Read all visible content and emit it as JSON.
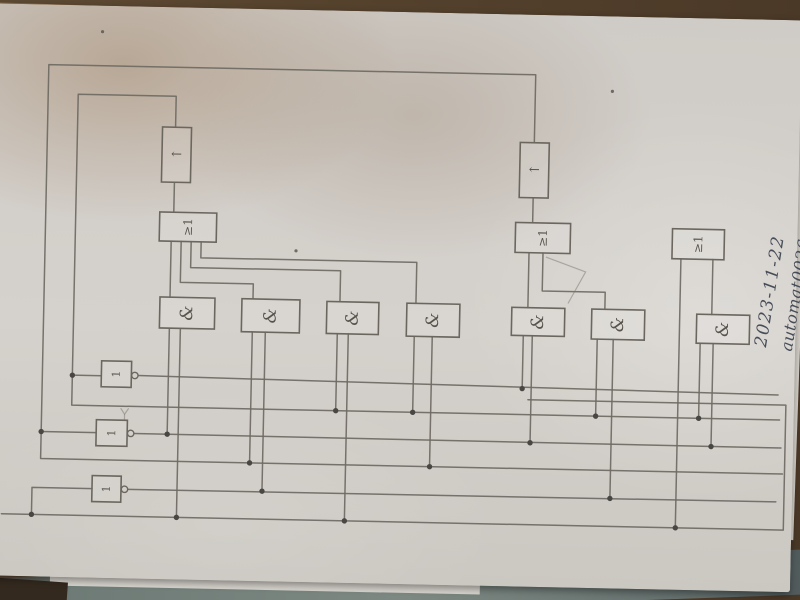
{
  "photo": {
    "handwriting": {
      "date": "2023-11-22",
      "filename": "automat0026.txt"
    }
  },
  "colors": {
    "pencil_line": "#6e6a63",
    "pencil_text": "#56534c",
    "ink_handwriting": "#474d58",
    "paper": "#d2cec9",
    "table_wood": "#55422d",
    "table_green": "#7d8882",
    "under_sheet_tan": "#c89f6c"
  },
  "schematic": {
    "boxes": [
      {
        "id": "ff1",
        "type": "flipflop-box",
        "label": "←",
        "x": 159,
        "y": 132,
        "w": 29,
        "h": 55,
        "rot": false,
        "fs": 13
      },
      {
        "id": "ff2",
        "type": "flipflop-box",
        "label": "←",
        "x": 517,
        "y": 140,
        "w": 29,
        "h": 55,
        "rot": false,
        "fs": 13
      },
      {
        "id": "or1",
        "type": "or-gate",
        "label": "≥1",
        "x": 158,
        "y": 217,
        "w": 57,
        "h": 29,
        "rot": true,
        "fs": 12
      },
      {
        "id": "or2",
        "type": "or-gate",
        "label": "≥1",
        "x": 514,
        "y": 220,
        "w": 55,
        "h": 30,
        "rot": true,
        "fs": 12
      },
      {
        "id": "or3",
        "type": "or-gate",
        "label": "≥1",
        "x": 671,
        "y": 223,
        "w": 52,
        "h": 30,
        "rot": true,
        "fs": 12
      },
      {
        "id": "not1",
        "type": "not-gate",
        "label": "1",
        "x": 103,
        "y": 367,
        "w": 30,
        "h": 26,
        "rot": true,
        "fs": 11
      },
      {
        "id": "not2",
        "type": "not-gate",
        "label": "1",
        "x": 99,
        "y": 426,
        "w": 31,
        "h": 26,
        "rot": true,
        "fs": 11
      },
      {
        "id": "not3",
        "type": "not-gate",
        "label": "1",
        "x": 96,
        "y": 482,
        "w": 29,
        "h": 26,
        "rot": true,
        "fs": 11
      },
      {
        "id": "and1",
        "type": "and-gate",
        "label": "&",
        "x": 160,
        "y": 302,
        "w": 55,
        "h": 31,
        "rot": true,
        "fs": 17
      },
      {
        "id": "and2",
        "type": "and-gate",
        "label": "&",
        "x": 242,
        "y": 302,
        "w": 58,
        "h": 33,
        "rot": true,
        "fs": 17
      },
      {
        "id": "and3",
        "type": "and-gate",
        "label": "&",
        "x": 327,
        "y": 303,
        "w": 52,
        "h": 32,
        "rot": true,
        "fs": 17
      },
      {
        "id": "and4",
        "type": "and-gate",
        "label": "&",
        "x": 407,
        "y": 303,
        "w": 53,
        "h": 33,
        "rot": true,
        "fs": 17
      },
      {
        "id": "and5",
        "type": "and-gate",
        "label": "&",
        "x": 512,
        "y": 305,
        "w": 53,
        "h": 28,
        "rot": true,
        "fs": 17
      },
      {
        "id": "and6",
        "type": "and-gate",
        "label": "&",
        "x": 592,
        "y": 305,
        "w": 53,
        "h": 30,
        "rot": true,
        "fs": 17
      },
      {
        "id": "and7",
        "type": "and-gate",
        "label": "&",
        "x": 697,
        "y": 308,
        "w": 53,
        "h": 29,
        "rot": true,
        "fs": 17
      }
    ],
    "wires": [
      {
        "id": "q2-feedback-loop",
        "points": "531,140 531,72 44,72 44,466 786,466"
      },
      {
        "id": "q1-feedback-loop",
        "points": "172,132 172,101 74,101 74,412 782,412"
      },
      {
        "id": "ff1-input",
        "points": "172,187 172,217"
      },
      {
        "id": "ff2-input",
        "points": "531,195 531,220"
      },
      {
        "id": "or1-in-and1",
        "points": "170,246 170,302"
      },
      {
        "id": "or1-in-and2",
        "points": "180,246 180,287 253,287 253,302"
      },
      {
        "id": "or1-in-and3",
        "points": "190,246 190,272 340,272 340,303"
      },
      {
        "id": "or1-in-and4",
        "points": "200,246 200,262 416,262 416,303"
      },
      {
        "id": "or2-in-and5",
        "points": "528,250 528,305"
      },
      {
        "id": "or2-in-and6",
        "points": "542,250 542,288 605,288 605,305"
      },
      {
        "id": "or3-in-and7",
        "points": "712,253 712,308"
      },
      {
        "id": "or3-bus-tap",
        "points": "680,253 680,522"
      },
      {
        "id": "input-bus",
        "points": "6,522 788,522 788,397 530,397"
      },
      {
        "id": "not1-out-bus",
        "points": "140,381 780,387"
      },
      {
        "id": "not2-out-bus",
        "points": "137,439 784,440"
      },
      {
        "id": "not3-out-bus",
        "points": "132,495 780,494"
      },
      {
        "id": "not1-in",
        "points": "74,382 103,382"
      },
      {
        "id": "not2-in",
        "points": "44,439 99,439"
      },
      {
        "id": "not3-in",
        "points": "96,495 36,495 36,522"
      },
      {
        "id": "and1-in-a",
        "points": "170,333 170,439"
      },
      {
        "id": "and1-in-b",
        "points": "181,333 181,522"
      },
      {
        "id": "and2-in-a",
        "points": "253,335 253,466"
      },
      {
        "id": "and2-in-b",
        "points": "266,335 266,494"
      },
      {
        "id": "and3-in-a",
        "points": "338,335 338,412"
      },
      {
        "id": "and3-in-b",
        "points": "349,335 349,522"
      },
      {
        "id": "and4-in-a",
        "points": "415,336 415,412"
      },
      {
        "id": "and4-in-b",
        "points": "433,336 433,466"
      },
      {
        "id": "and5-in-a",
        "points": "524,333 524,386"
      },
      {
        "id": "and5-in-b",
        "points": "533,333 533,440"
      },
      {
        "id": "and6-in-a",
        "points": "598,335 598,412"
      },
      {
        "id": "and6-in-b",
        "points": "614,335 614,494"
      },
      {
        "id": "and7-in-a",
        "points": "701,337 701,412"
      },
      {
        "id": "and7-in-b",
        "points": "714,337 714,440"
      }
    ],
    "junction_dots": [
      [
        74,
        382
      ],
      [
        44,
        439
      ],
      [
        36,
        522
      ],
      [
        170,
        439
      ],
      [
        181,
        522
      ],
      [
        253,
        466
      ],
      [
        266,
        494
      ],
      [
        338,
        412
      ],
      [
        349,
        522
      ],
      [
        415,
        412
      ],
      [
        433,
        466
      ],
      [
        524,
        386
      ],
      [
        533,
        440
      ],
      [
        598,
        412
      ],
      [
        614,
        494
      ],
      [
        701,
        412
      ],
      [
        714,
        440
      ],
      [
        680,
        522
      ]
    ],
    "inverter_bubbles": [
      [
        136.5,
        381
      ],
      [
        133.5,
        439
      ],
      [
        128.5,
        495
      ]
    ],
    "pencil_marks": [
      {
        "id": "stray-arc",
        "points": "545,254 585,268 568,300"
      },
      {
        "id": "stray-tick",
        "points": "123,414 127,420 131,414"
      },
      {
        "id": "stray-tick2",
        "points": "127,420 127,426"
      }
    ],
    "specks": [
      [
        97,
        38
      ],
      [
        295,
        253
      ],
      [
        608,
        87
      ]
    ]
  }
}
